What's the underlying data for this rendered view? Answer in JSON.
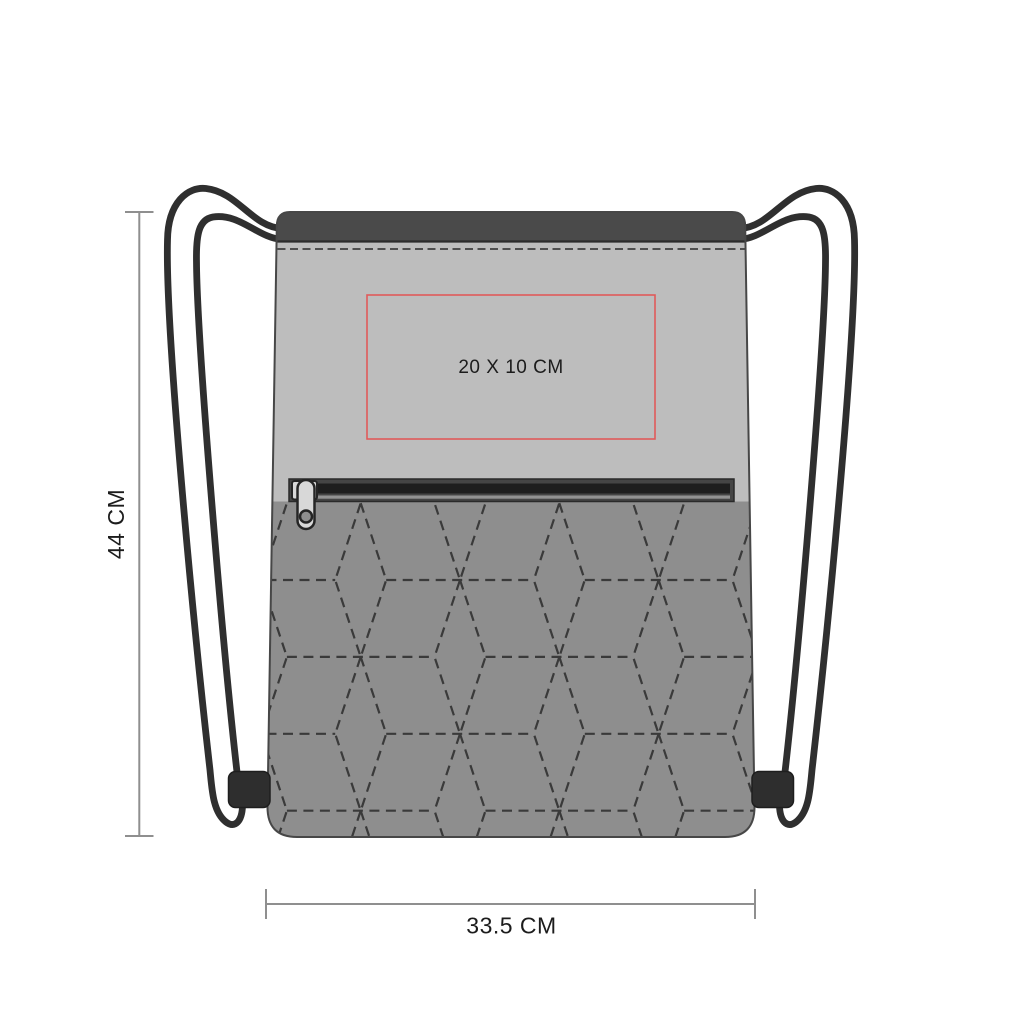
{
  "print_area": {
    "label": "20 X 10 CM",
    "border_color": "#e05a5a"
  },
  "dimensions": {
    "height": {
      "label": "44 CM"
    },
    "width": {
      "label": "33.5 CM"
    }
  },
  "colors": {
    "top_band": "#4a4a4a",
    "upper_panel": "#bdbdbd",
    "quilted_panel": "#8e8e8e",
    "stitch": "#3a3a3a",
    "cord": "#2f2f2f",
    "tab": "#2e2e2e",
    "zipper_frame": "#454545",
    "zipper_dark": "#1e1e1e",
    "zipper_stripe": "#929292",
    "puller": "#d8d8d8",
    "dimension_line": "#8f8f8f",
    "text": "#1c1c1c",
    "background": "#ffffff"
  }
}
